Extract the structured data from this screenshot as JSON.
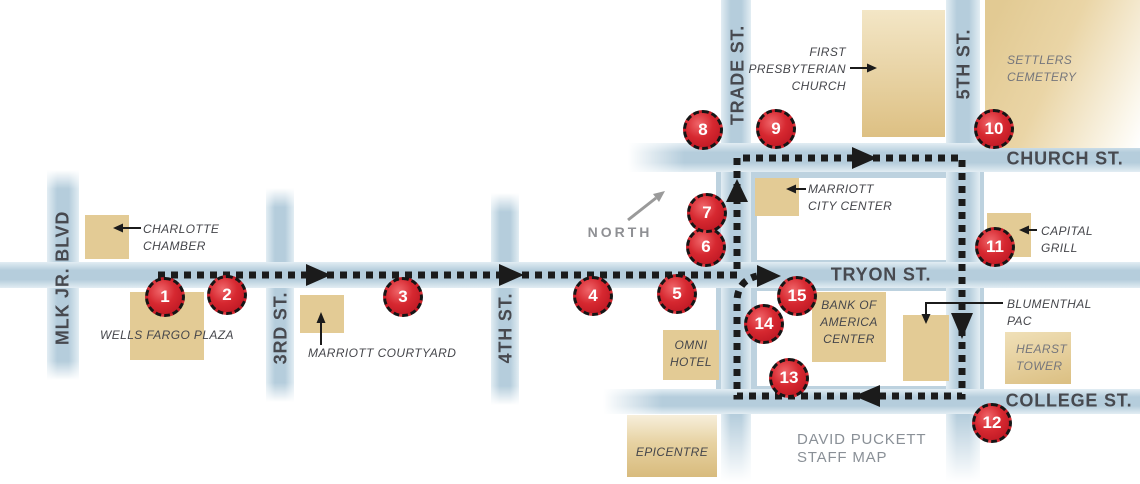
{
  "map": {
    "width": 1140,
    "height": 484,
    "colors": {
      "street_mid": "#b5cddc",
      "street_edge": "#e2edf3",
      "district": "#bdd2df",
      "building_tan": "#e3cb95",
      "route_black": "#1b1b1b",
      "stop_red": "#d62830",
      "label_dark": "#45464b",
      "label_gray": "#75767c",
      "street_label_gray": "#47494f",
      "north_gray": "#9a9a9a",
      "footer_gray": "#8a9097"
    },
    "district": {
      "x": 716,
      "y": 143,
      "w": 268,
      "h": 270
    },
    "blocks": [
      {
        "id": "block-church-tryon",
        "x": 757,
        "y": 178,
        "w": 190,
        "h": 82
      },
      {
        "id": "block-tryon-college",
        "x": 757,
        "y": 291,
        "w": 190,
        "h": 95
      }
    ],
    "streets": [
      {
        "id": "mlk-jr-blvd",
        "label": "MLK JR. BLVD",
        "orient": "v",
        "x": 47,
        "y": 170,
        "w": 32,
        "h": 210,
        "fade": "both",
        "lx": 63,
        "ly": 278
      },
      {
        "id": "3rd-street",
        "label": "3RD ST.",
        "orient": "v",
        "x": 266,
        "y": 188,
        "w": 28,
        "h": 214,
        "fade": "both",
        "lx": 281,
        "ly": 328
      },
      {
        "id": "4th-street",
        "label": "4TH ST.",
        "orient": "v",
        "x": 491,
        "y": 193,
        "w": 28,
        "h": 212,
        "fade": "both",
        "lx": 506,
        "ly": 328
      },
      {
        "id": "trade-street",
        "label": "TRADE ST.",
        "orient": "v",
        "x": 721,
        "y": 0,
        "w": 30,
        "h": 482,
        "fade": "bottom",
        "lx": 738,
        "ly": 75
      },
      {
        "id": "5th-street",
        "label": "5TH ST.",
        "orient": "v",
        "x": 946,
        "y": 0,
        "w": 34,
        "h": 482,
        "fade": "bottom",
        "lx": 964,
        "ly": 64
      },
      {
        "id": "church-street",
        "label": "CHURCH ST.",
        "orient": "h",
        "x": 628,
        "y": 143,
        "w": 512,
        "h": 29,
        "fade": "left",
        "lx": 1065,
        "ly": 159
      },
      {
        "id": "tryon-street",
        "label": "TRYON ST.",
        "orient": "h",
        "x": 0,
        "y": 262,
        "w": 1140,
        "h": 26,
        "fade": "none",
        "lx": 881,
        "ly": 275
      },
      {
        "id": "college-street",
        "label": "COLLEGE ST.",
        "orient": "h",
        "x": 603,
        "y": 389,
        "w": 537,
        "h": 25,
        "fade": "left",
        "lx": 1069,
        "ly": 401
      }
    ],
    "buildings": [
      {
        "id": "charlotte-chamber",
        "x": 85,
        "y": 215,
        "w": 44,
        "h": 44
      },
      {
        "id": "wells-fargo-plaza",
        "x": 130,
        "y": 292,
        "w": 74,
        "h": 68
      },
      {
        "id": "marriott-courtyard",
        "x": 300,
        "y": 295,
        "w": 44,
        "h": 38
      },
      {
        "id": "first-presbyterian-church",
        "x": 862,
        "y": 10,
        "w": 83,
        "h": 127
      },
      {
        "id": "settlers-cemetery-grounds",
        "x": 985,
        "y": 0,
        "w": 155,
        "h": 148
      },
      {
        "id": "marriott-city-center",
        "x": 755,
        "y": 178,
        "w": 44,
        "h": 38
      },
      {
        "id": "capital-grill",
        "x": 987,
        "y": 213,
        "w": 44,
        "h": 44
      },
      {
        "id": "bank-of-america-center",
        "x": 812,
        "y": 292,
        "w": 74,
        "h": 70
      },
      {
        "id": "blumenthal-pac",
        "x": 903,
        "y": 315,
        "w": 46,
        "h": 66
      },
      {
        "id": "hearst-tower",
        "x": 1005,
        "y": 332,
        "w": 66,
        "h": 52
      },
      {
        "id": "omni-hotel",
        "x": 663,
        "y": 330,
        "w": 56,
        "h": 50
      },
      {
        "id": "epicentre",
        "x": 627,
        "y": 415,
        "w": 90,
        "h": 62
      }
    ],
    "labels": [
      {
        "id": "charlotte-chamber-label",
        "lines": [
          "CHARLOTTE",
          "CHAMBER"
        ],
        "x": 143,
        "y": 221,
        "w": 95,
        "align": "left",
        "tone": "dark"
      },
      {
        "id": "wells-fargo-plaza-label",
        "lines": [
          "WELLS FARGO PLAZA"
        ],
        "x": 100,
        "y": 327,
        "w": 145,
        "align": "left",
        "tone": "dark"
      },
      {
        "id": "marriott-courtyard-label",
        "lines": [
          "MARRIOTT COURTYARD"
        ],
        "x": 308,
        "y": 345,
        "w": 150,
        "align": "left",
        "tone": "dark"
      },
      {
        "id": "first-presbyterian-church-label",
        "lines": [
          "FIRST",
          "PRESBYTERIAN",
          "CHURCH"
        ],
        "x": 746,
        "y": 44,
        "w": 100,
        "align": "right",
        "tone": "dark"
      },
      {
        "id": "marriott-city-center-label",
        "lines": [
          "MARRIOTT",
          "CITY CENTER"
        ],
        "x": 808,
        "y": 181,
        "w": 100,
        "align": "left",
        "tone": "dark"
      },
      {
        "id": "settlers-cemetery-label",
        "lines": [
          "SETTLERS",
          "CEMETERY"
        ],
        "x": 1007,
        "y": 52,
        "w": 90,
        "align": "left",
        "tone": "gray"
      },
      {
        "id": "capital-grill-label",
        "lines": [
          "CAPITAL",
          "GRILL"
        ],
        "x": 1041,
        "y": 223,
        "w": 70,
        "align": "left",
        "tone": "dark"
      },
      {
        "id": "blumenthal-pac-label",
        "lines": [
          "BLUMENTHAL",
          "PAC"
        ],
        "x": 1007,
        "y": 296,
        "w": 95,
        "align": "left",
        "tone": "dark"
      },
      {
        "id": "hearst-tower-label",
        "lines": [
          "HEARST",
          "TOWER"
        ],
        "x": 1016,
        "y": 341,
        "w": 60,
        "align": "left",
        "tone": "gray"
      },
      {
        "id": "omni-hotel-label",
        "lines": [
          "OMNI",
          "HOTEL"
        ],
        "x": 663,
        "y": 337,
        "w": 56,
        "align": "center",
        "tone": "dark"
      },
      {
        "id": "bank-of-america-center-label",
        "lines": [
          "BANK OF",
          "AMERICA",
          "CENTER"
        ],
        "x": 812,
        "y": 297,
        "w": 74,
        "align": "center",
        "tone": "dark"
      },
      {
        "id": "epicentre-label",
        "lines": [
          "EPICENTRE"
        ],
        "x": 627,
        "y": 444,
        "w": 90,
        "align": "center",
        "tone": "dark"
      }
    ],
    "north": {
      "label": "NORTH",
      "x": 620,
      "y": 232
    },
    "footer": {
      "lines": [
        "DAVID PUCKETT",
        "STAFF MAP"
      ],
      "x": 797,
      "y": 431
    },
    "stops": [
      {
        "n": "1",
        "x": 165,
        "y": 297
      },
      {
        "n": "2",
        "x": 227,
        "y": 295
      },
      {
        "n": "3",
        "x": 403,
        "y": 297
      },
      {
        "n": "4",
        "x": 593,
        "y": 296
      },
      {
        "n": "5",
        "x": 677,
        "y": 294
      },
      {
        "n": "6",
        "x": 706,
        "y": 247
      },
      {
        "n": "7",
        "x": 707,
        "y": 213
      },
      {
        "n": "8",
        "x": 703,
        "y": 130
      },
      {
        "n": "9",
        "x": 776,
        "y": 129
      },
      {
        "n": "10",
        "x": 994,
        "y": 129
      },
      {
        "n": "11",
        "x": 995,
        "y": 247
      },
      {
        "n": "12",
        "x": 992,
        "y": 423
      },
      {
        "n": "13",
        "x": 789,
        "y": 378
      },
      {
        "n": "14",
        "x": 764,
        "y": 324
      },
      {
        "n": "15",
        "x": 797,
        "y": 296
      }
    ],
    "route": {
      "path": "M158 275 L737 275 L737 158 L962 158 L962 396 L737 396 L737 302 Q737 281 757 276",
      "dash": "7 6",
      "width": 7,
      "arrows": [
        {
          "id": "route-arrow-east-1",
          "points": "306,264 306,286 331,275"
        },
        {
          "id": "route-arrow-east-2",
          "points": "499,264 499,286 524,275"
        },
        {
          "id": "route-arrow-north-trade",
          "points": "726,202 748,202 737,179"
        },
        {
          "id": "route-arrow-east-church",
          "points": "852,147 852,169 877,158"
        },
        {
          "id": "route-arrow-south-5th",
          "points": "951,313 973,313 962,339"
        },
        {
          "id": "route-arrow-west-college",
          "points": "880,385 880,407 854,396"
        },
        {
          "id": "route-arrow-east-end",
          "points": "757,265 757,287 781,276"
        }
      ]
    },
    "connectors": [
      {
        "id": "charlotte-chamber-pointer",
        "pts": "141,228 122,228",
        "head": "113,228 123,223.5 123,232.5",
        "gray": false
      },
      {
        "id": "marriott-courtyard-pointer",
        "pts": "321,345 321,322",
        "head": "321,312 316.5,323 325.5,323",
        "gray": false
      },
      {
        "id": "first-presbyterian-pointer",
        "pts": "850,68 868,68",
        "head": "877,68 867,63.5 867,72.5",
        "gray": false
      },
      {
        "id": "marriott-city-center-pointer",
        "pts": "806,189 795,189",
        "head": "786,189 796,184.5 796,193.5",
        "gray": false
      },
      {
        "id": "capital-grill-pointer",
        "pts": "1037,230 1028,230",
        "head": "1019,230 1029,225.5 1029,234.5",
        "gray": false
      },
      {
        "id": "blumenthal-pac-pointer",
        "pts": "1003,303 926,303 926,315",
        "head": "926,324 921.5,314 930.5,314",
        "gray": false
      },
      {
        "id": "north-arrow",
        "pts": "628,220 656,198",
        "head": "665,191 659,202 653,194",
        "gray": true
      }
    ]
  }
}
